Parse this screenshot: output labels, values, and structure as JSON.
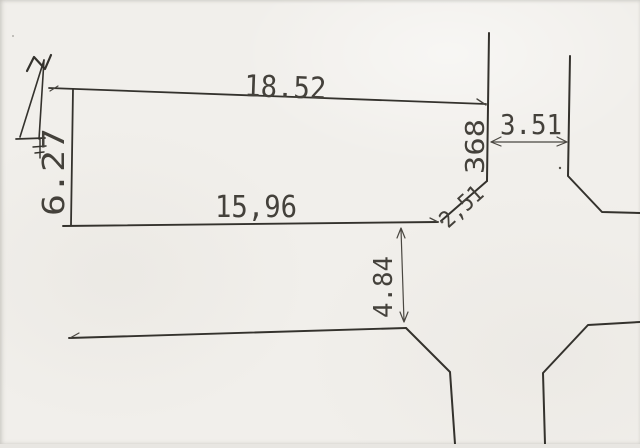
{
  "drawing": {
    "measurements": {
      "parcel_top_edge": "18.52",
      "parcel_bottom_edge": "15,96",
      "parcel_left_edge": "6.27",
      "corner_cut": "2,51",
      "street_frontage": "368",
      "street_width_right": "3.51",
      "road_offset_bottom": "4.84"
    },
    "icons": {
      "north_arrow": "north-arrow-icon"
    },
    "colors": {
      "paper": "#f1efeb",
      "ink": "#34322d",
      "text": "#44413b"
    }
  }
}
